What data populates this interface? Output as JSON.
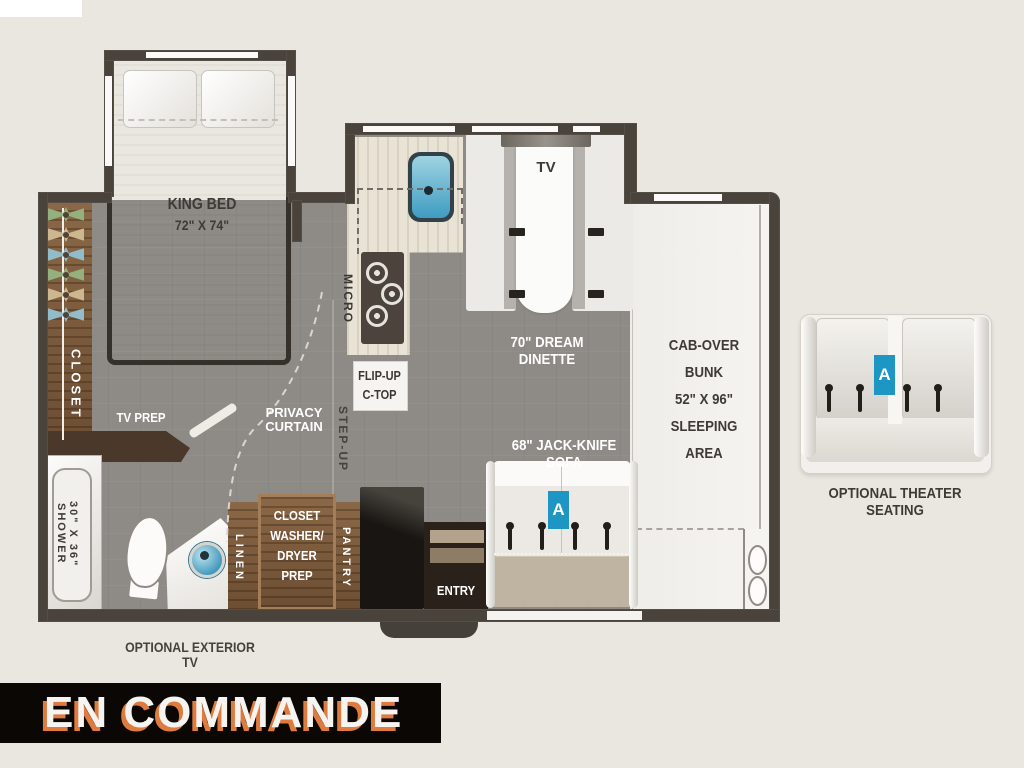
{
  "status_banner": {
    "label": "EN COMMANDE"
  },
  "bedroom": {
    "bed": {
      "name": "KING BED",
      "size": "72\" X 74\""
    },
    "closet_label": "CLOSET",
    "tv_prep_label": "TV PREP",
    "privacy_curtain": {
      "line1": "PRIVACY",
      "line2": "CURTAIN"
    }
  },
  "bathroom": {
    "shower": {
      "name": "SHOWER",
      "size": "30\" X 36\""
    }
  },
  "kitchen": {
    "micro_label": "MICRO",
    "flip_up": {
      "line1": "FLIP-UP",
      "line2": "C-TOP"
    },
    "step_up_label": "STEP-UP"
  },
  "storage": {
    "linen_label": "LINEN",
    "pantry_label": "PANTRY",
    "washer_prep_lines": [
      "CLOSET",
      "WASHER/",
      "DRYER",
      "PREP"
    ]
  },
  "entry": {
    "label": "ENTRY"
  },
  "dinette": {
    "tv_label": "TV",
    "label": "70\" DREAM DINETTE"
  },
  "sofa": {
    "label": "68\" JACK-KNIFE SOFA",
    "badge": "A"
  },
  "cab_over": {
    "lines": [
      "CAB-OVER",
      "BUNK",
      "52\" X 96\"",
      "SLEEPING",
      "AREA"
    ]
  },
  "exterior_tv_label": "OPTIONAL EXTERIOR TV",
  "theater": {
    "label": "OPTIONAL THEATER SEATING",
    "badge": "A"
  },
  "colors": {
    "badge_blue": "#1e96c4",
    "banner_bg": "#0a0705",
    "banner_text_shadow": "#df7b3e",
    "wall": "#4a433c",
    "floor_gray": "#8e8b87",
    "wood_brown": "#7a5a3d",
    "sink_blue": "#3f9cc1"
  }
}
